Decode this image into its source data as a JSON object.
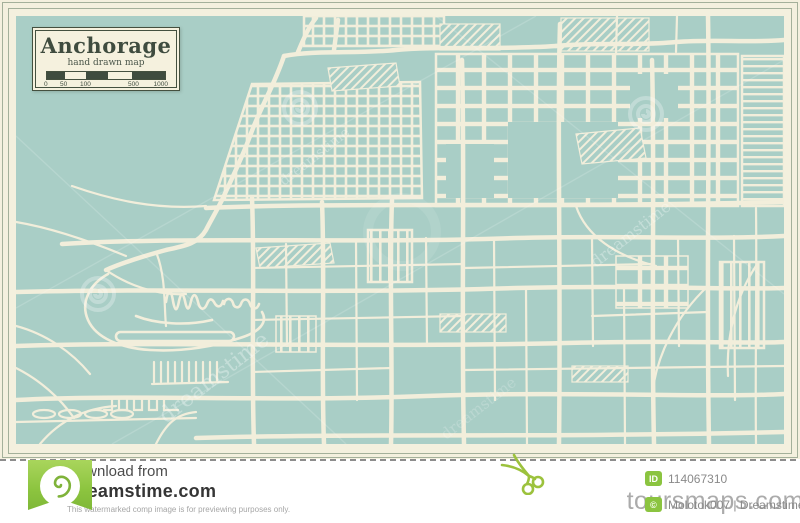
{
  "image": {
    "title_box": {
      "title": "Anchorage",
      "subtitle": "hand drawn map",
      "scale_labels": [
        "0",
        "50",
        "100",
        "500",
        "1000"
      ]
    },
    "watermark": {
      "text": "dreamstime"
    }
  },
  "footer": {
    "download_label": "Download from",
    "site_name": "Dreamstime.com",
    "disclaimer": "This watermarked comp image is for previewing purposes only.",
    "id_badge": "ID",
    "id_value": "114067310",
    "copyright_badge": "©",
    "credit": "Molotok007 | Dreamstime.com",
    "overlay_watermark": "toursmaps.com"
  },
  "colors": {
    "map_water_teal": "#a9cec6",
    "map_road_cream": "#f2eedb",
    "frame_cream": "#f3f0de",
    "title_dark_green": "#3f4c3f",
    "dreamstime_green": "#8bc440"
  }
}
